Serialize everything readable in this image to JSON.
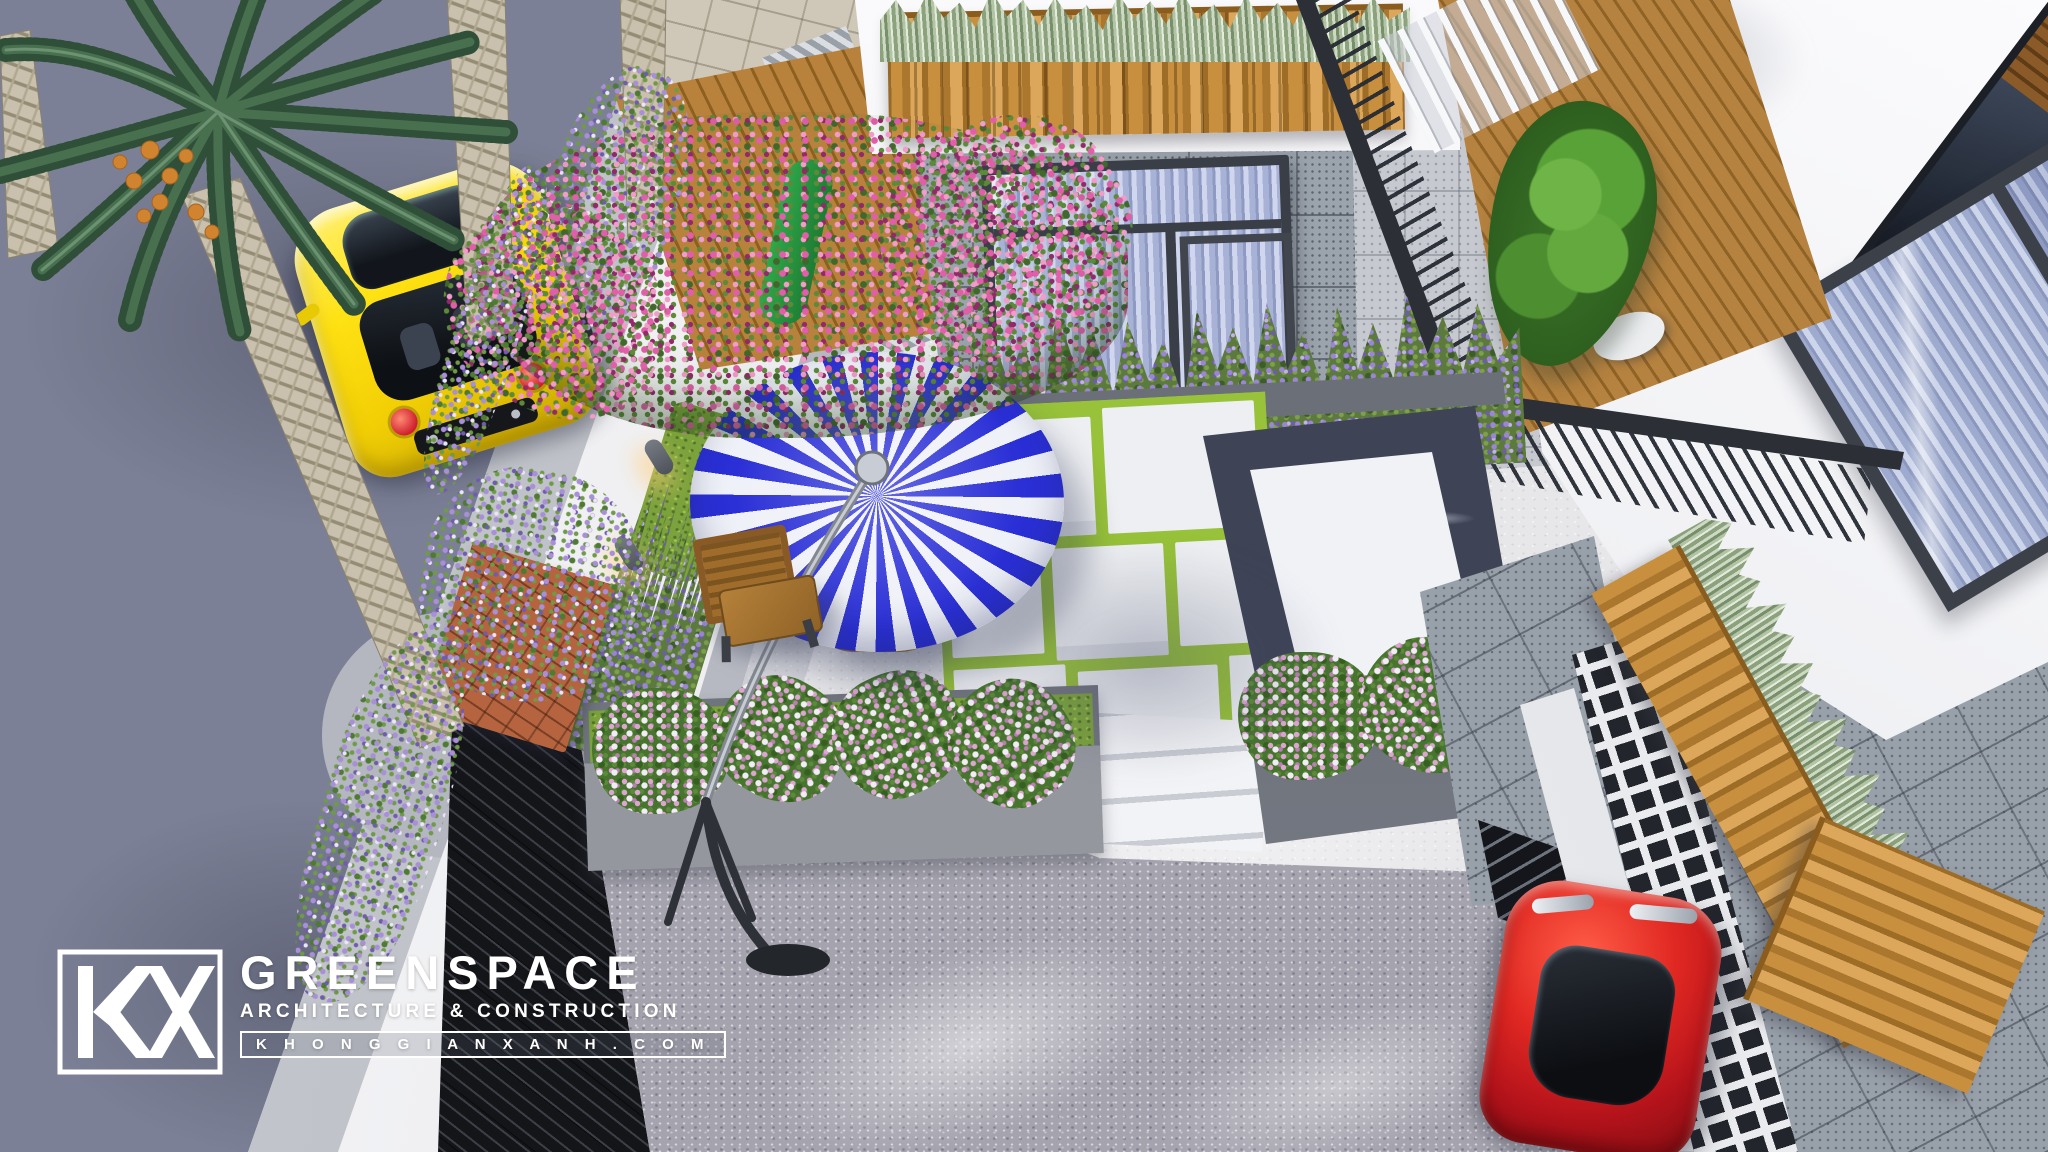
{
  "watermark": {
    "logo_mark": "KX",
    "brand": "GREENSPACE",
    "tagline": "ARCHITECTURE & CONSTRUCTION",
    "website": "K H O N G G I A N X A N H . C O M"
  },
  "scene": {
    "type": "3d-architectural-render",
    "view": "aerial top-down of modern townhouse front courtyard",
    "objects": {
      "street": "asphalt road with tree shadows",
      "sidewalk": "light paved walk with curved curb corner",
      "perimeter-wall": "white boundary wall with two warm sconce lamps and black slatted gate",
      "courtyard": "light concrete terrace with cantilever parasol, wooden chair and table",
      "parasol": "blue and white striped cantilever umbrella",
      "paving": "white slabs with grass joints beside dark-bordered white marble walk and steps",
      "planters": "concrete beds with pink-white flower bushes, lavender rows, brick flower box, timber boxes with silver sansevieria",
      "trees": "date palms over street, pink bougainvillea, cypress on balcony",
      "house": "white facades, gray stone tile walls, dark aluminium windows with blue curtains, timber decks, black railings, breeze-block screen",
      "vehicles": "yellow sports car on street, red car at driveway"
    },
    "palette": {
      "street": "#7c8096",
      "sidewalk": "#b8bbc2",
      "wall_white": "#f3f4f6",
      "court_floor": "#e8e8ea",
      "driveway": "#a4a3ae",
      "umbrella_blue": "#2a2fd6",
      "umbrella_white": "#eff1f8",
      "car_yellow": "#f5d50a",
      "car_red": "#cf1d20",
      "grass_joint": "#a4d23f",
      "marble_dark": "#3e4356",
      "marble_white": "#f0f2f6",
      "wood": "#c18a3c",
      "bougainvillea": "#e05fa8",
      "lavender": "#9b85d6",
      "window_frame": "#3a3e46",
      "curtain_blue": "#a8b2d6"
    }
  }
}
